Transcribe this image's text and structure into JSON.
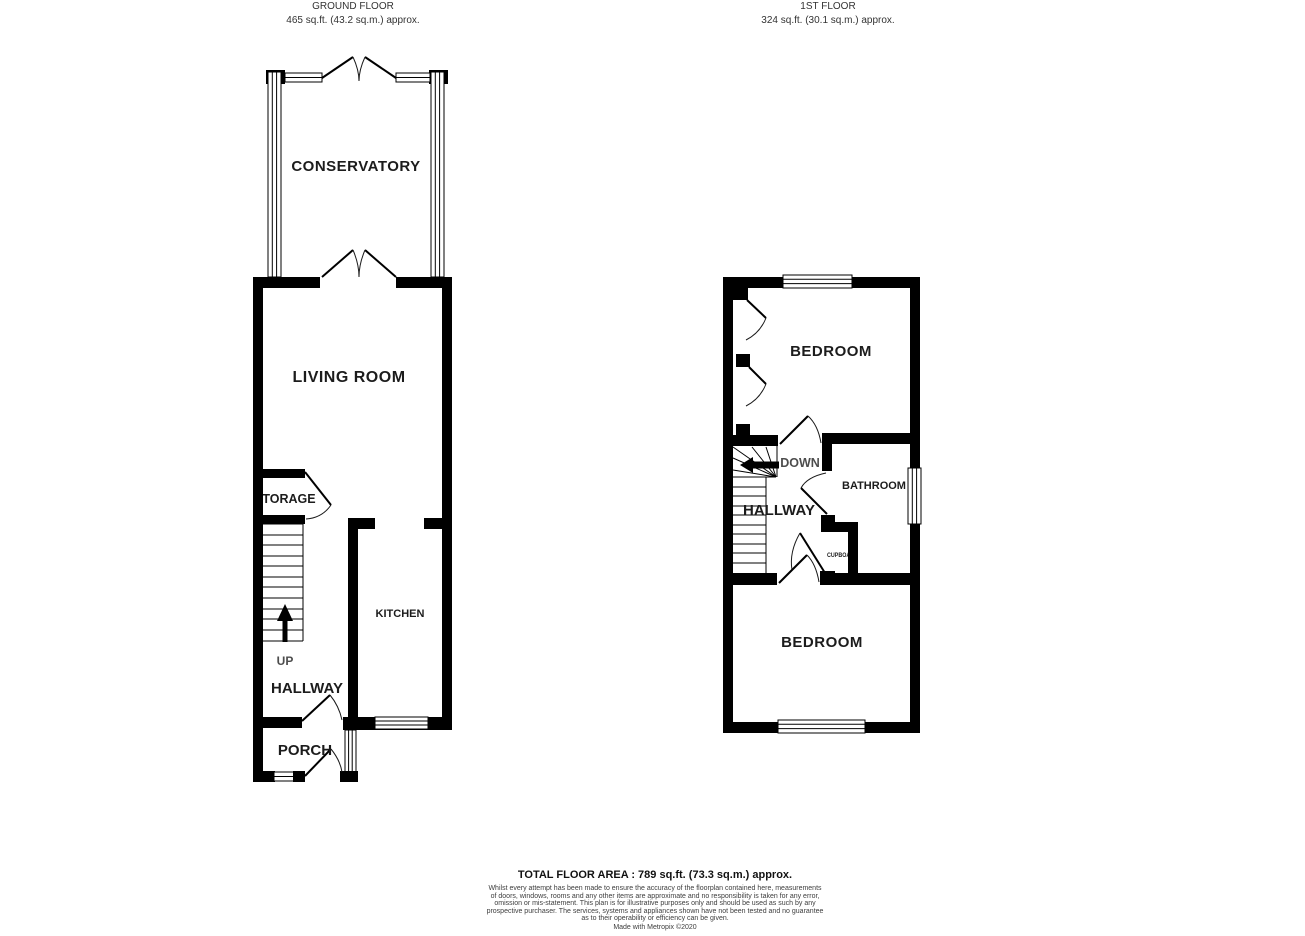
{
  "ground_floor": {
    "title": "GROUND FLOOR",
    "area": "465 sq.ft. (43.2 sq.m.) approx.",
    "rooms": {
      "conservatory": "CONSERVATORY",
      "living_room": "LIVING ROOM",
      "storage": "STORAGE",
      "kitchen": "KITCHEN",
      "hallway": "HALLWAY",
      "porch": "PORCH",
      "stairs_direction": "UP"
    }
  },
  "first_floor": {
    "title": "1ST FLOOR",
    "area": "324 sq.ft. (30.1 sq.m.) approx.",
    "rooms": {
      "bedroom_top": "BEDROOM",
      "bedroom_bottom": "BEDROOM",
      "bathroom": "BATHROOM",
      "hallway": "HALLWAY",
      "cupboard": "CUPBOARD",
      "stairs_direction": "DOWN"
    }
  },
  "icons": {
    "stairs_up_arrow": "up-arrow",
    "stairs_down_arrow": "left-arrow"
  },
  "footer": {
    "total_area": "TOTAL FLOOR AREA : 789 sq.ft. (73.3 sq.m.) approx.",
    "disclaimer_lines": [
      "Whilst every attempt has been made to ensure the accuracy of the floorplan contained here, measurements",
      "of doors, windows, rooms and any other items are approximate and no responsibility is taken for any error,",
      "omission or mis-statement. This plan is for illustrative purposes only and should be used as such by any",
      "prospective purchaser. The services, systems and appliances shown have not been tested and no guarantee",
      "as to their operability or efficiency can be given.",
      "Made with Metropix ©2020"
    ]
  },
  "colors": {
    "wall": "#000000",
    "text": "#1c1c1c",
    "muted_text": "#4d4d4d",
    "background": "#ffffff"
  }
}
